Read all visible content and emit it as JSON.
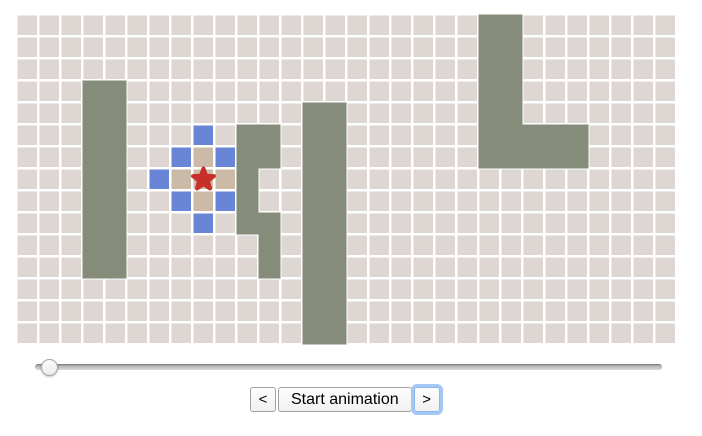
{
  "app": {
    "background": "#ffffff"
  },
  "grid": {
    "cols": 30,
    "rows": 15,
    "cell_size": 22,
    "origin": {
      "x": 16,
      "y": 14
    },
    "colors": {
      "floor": "#ddd6d3",
      "grid_line": "#ffffff",
      "wall": "#868c7a",
      "frontier": "#6885d6",
      "visited": "#cbbaa7",
      "start": "#c62f2a"
    },
    "wall_rects": [
      {
        "col": 3,
        "row": 3,
        "w": 2,
        "h": 9
      },
      {
        "col": 10,
        "row": 5,
        "w": 1,
        "h": 5
      },
      {
        "col": 11,
        "row": 5,
        "w": 1,
        "h": 2
      },
      {
        "col": 11,
        "row": 9,
        "w": 1,
        "h": 3
      },
      {
        "col": 13,
        "row": 4,
        "w": 2,
        "h": 11
      },
      {
        "col": 21,
        "row": 0,
        "w": 2,
        "h": 7
      },
      {
        "col": 23,
        "row": 5,
        "w": 3,
        "h": 2
      }
    ],
    "frontier_cells": [
      {
        "col": 8,
        "row": 5
      },
      {
        "col": 7,
        "row": 6
      },
      {
        "col": 9,
        "row": 6
      },
      {
        "col": 6,
        "row": 7
      },
      {
        "col": 7,
        "row": 8
      },
      {
        "col": 9,
        "row": 8
      },
      {
        "col": 8,
        "row": 9
      }
    ],
    "visited_cells": [
      {
        "col": 8,
        "row": 6
      },
      {
        "col": 7,
        "row": 7
      },
      {
        "col": 8,
        "row": 7
      },
      {
        "col": 9,
        "row": 7
      },
      {
        "col": 8,
        "row": 8
      }
    ],
    "start": {
      "col": 8,
      "row": 7
    }
  },
  "slider": {
    "value_percent": 1
  },
  "controls": {
    "prev_label": "<",
    "play_label": "Start animation",
    "next_label": ">",
    "focused": "next"
  }
}
